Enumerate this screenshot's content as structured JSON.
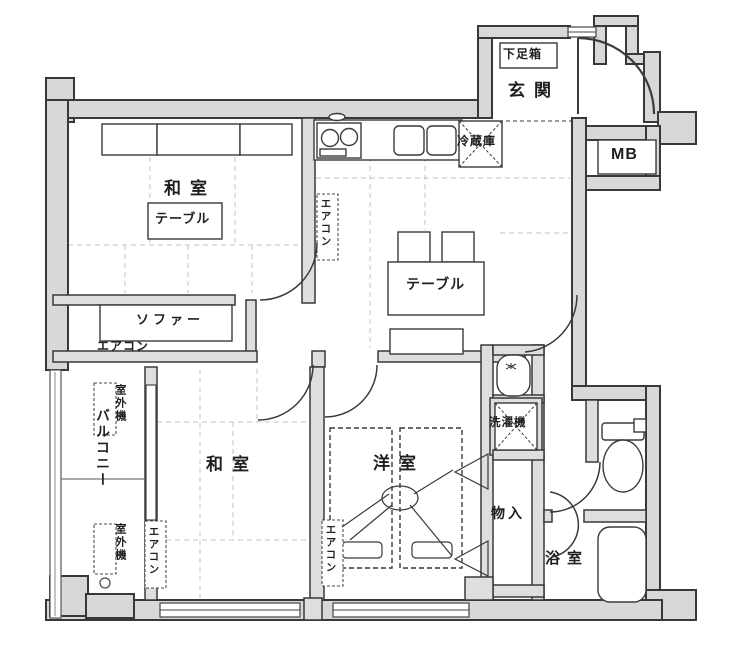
{
  "title": "apartment-floor-plan",
  "labels": {
    "genkan": "玄関",
    "shoe_box": "下足箱",
    "meter_box": "MB",
    "refrigerator": "冷蔵庫",
    "washitsu_1": "和室",
    "table_1": "テーブル",
    "aircon_kitchen": "エアコン",
    "table_2": "テーブル",
    "sofa": "ソファー",
    "aircon_living": "エアコン",
    "outdoor_unit_1": "室外機",
    "balcony": "バルコニー",
    "outdoor_unit_2": "室外機",
    "washitsu_2": "和室",
    "aircon_washitsu2": "エアコン",
    "yoshitsu": "洋室",
    "aircon_yoshitsu": "エアコン",
    "storage": "物入",
    "washing_machine": "洗濯機",
    "bathroom": "浴室"
  },
  "colors": {
    "line": "#383838",
    "wall_fill": "#d8d8d8",
    "background": "#ffffff"
  }
}
